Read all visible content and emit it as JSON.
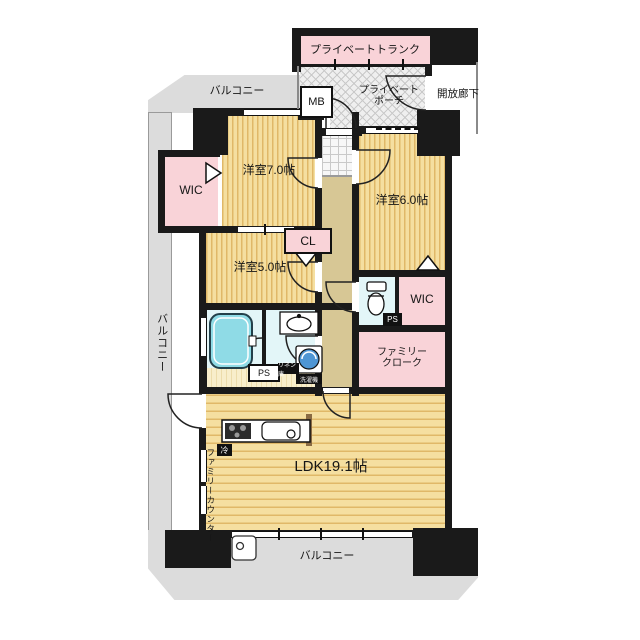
{
  "title": "マンション間取り図 3LDK",
  "colors": {
    "wall": "#1a1a1a",
    "room_pink": "#f9d3d8",
    "floor_base": "#f5dfa0",
    "floor_line": "#e0b868",
    "balcony_gray": "#dcdcdc",
    "hall_beige": "#d7c795",
    "bath_cyan": "#e3f6f8",
    "tub_cyan": "#8fdbe6",
    "washer_blue": "#4f96d4"
  },
  "labels": {
    "private_trunk": "プライベートトランク",
    "balcony_top": "バルコニー",
    "mb": "MB",
    "porch_line1": "プライベート",
    "porch_line2": "ポーチ",
    "open_corridor": "開放廊下",
    "bedroom_7": "洋室7.0帖",
    "wic_left": "WIC",
    "bedroom_5": "洋室5.0帖",
    "cl": "CL",
    "bedroom_6": "洋室6.0帖",
    "wic_right": "WIC",
    "ps_upper": "PS",
    "family_cloak_line1": "ファミリー",
    "family_cloak_line2": "クローク",
    "ps_lower": "PS",
    "linen": "リネン庫",
    "washer": "洗濯機",
    "fridge": "冷",
    "ldk": "LDK19.1帖",
    "family_counter": "ファミリーカウンター",
    "balcony_left": "バルコニー",
    "balcony_bottom": "バルコニー"
  }
}
